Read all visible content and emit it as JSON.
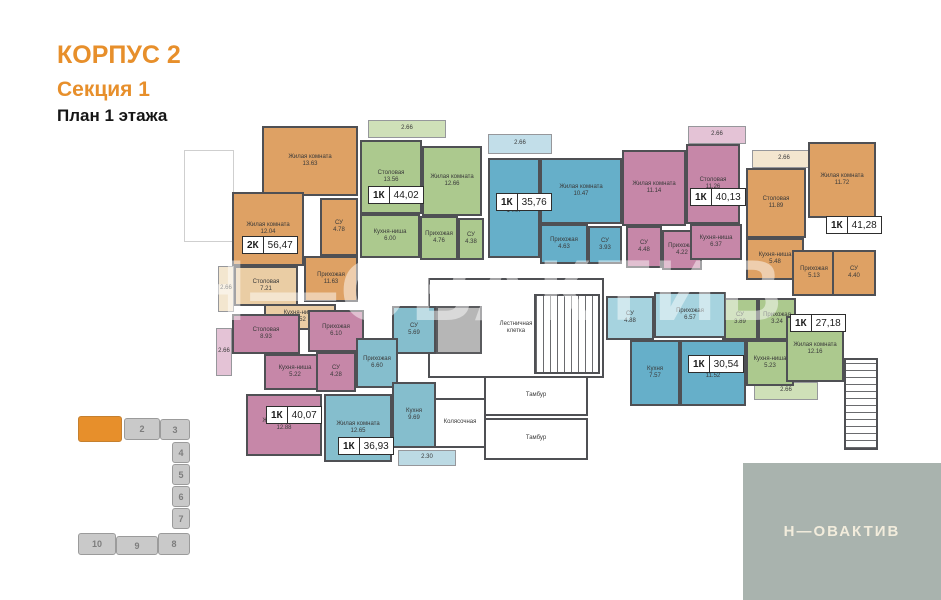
{
  "title": {
    "building": "КОРПУС 2",
    "section": "Секция 1",
    "floor": "План 1 этажа"
  },
  "watermark": "Н—ОВАКТИВ",
  "logo": {
    "text": "Н—ОВАКТИВ"
  },
  "palette": {
    "accent": "#E78F2B",
    "wall": "#4F5054",
    "orange": "#DEA164",
    "orange-light": "#EACDA4",
    "orange-pale": "#F3E6CF",
    "green": "#ACC98E",
    "green-pale": "#CFE0B8",
    "blue": "#66AFC9",
    "blue-light": "#A6D3DF",
    "blue-pale": "#C2DEE9",
    "pink": "#C687A8",
    "pink-pale": "#E4C3D6",
    "teal": "#85BECD",
    "teal-pale": "#BCDAE4",
    "logo-bg": "#A9B3AE",
    "minimap-gray": "#C9C9C9"
  },
  "plan": {
    "rooms": [
      {
        "id": "ghost-outline",
        "name": "",
        "area": "",
        "x": 184,
        "y": 150,
        "w": 50,
        "h": 92,
        "fill": "ghost"
      },
      {
        "id": "stairwell",
        "name": "Лестничная\nклетка",
        "area": "",
        "x": 428,
        "y": 278,
        "w": 176,
        "h": 100,
        "fill": "white"
      },
      {
        "id": "vestibule-1",
        "name": "Тамбур",
        "area": "",
        "x": 484,
        "y": 376,
        "w": 104,
        "h": 40,
        "fill": "white"
      },
      {
        "id": "stroller-room",
        "name": "Колясочная",
        "area": "",
        "x": 434,
        "y": 398,
        "w": 52,
        "h": 50,
        "fill": "white"
      },
      {
        "id": "vestibule-2",
        "name": "Тамбур",
        "area": "",
        "x": 484,
        "y": 418,
        "w": 104,
        "h": 42,
        "fill": "white"
      },
      {
        "id": "elevator",
        "name": "",
        "area": "",
        "x": 436,
        "y": 306,
        "w": 46,
        "h": 48,
        "fill": "elevator"
      },
      {
        "id": "stairs-main",
        "name": "",
        "area": "",
        "x": 534,
        "y": 294,
        "w": 66,
        "h": 80,
        "fill": "hatch-x"
      },
      {
        "id": "stairs-right",
        "name": "",
        "area": "",
        "x": 844,
        "y": 358,
        "w": 34,
        "h": 92,
        "fill": "hatch-y"
      },
      {
        "id": "apt1-living-1",
        "name": "Жилая комната",
        "area": "13.63",
        "x": 262,
        "y": 126,
        "w": 96,
        "h": 70,
        "fill": "orange"
      },
      {
        "id": "apt1-living-2",
        "name": "Жилая комната",
        "area": "12.04",
        "x": 232,
        "y": 192,
        "w": 72,
        "h": 74,
        "fill": "orange"
      },
      {
        "id": "apt1-bathroom",
        "name": "СУ",
        "area": "4.78",
        "x": 320,
        "y": 198,
        "w": 38,
        "h": 58,
        "fill": "orange"
      },
      {
        "id": "apt1-hallway",
        "name": "Прихожая",
        "area": "11.63",
        "x": 304,
        "y": 256,
        "w": 54,
        "h": 46,
        "fill": "orange"
      },
      {
        "id": "apt1-dining",
        "name": "Столовая",
        "area": "7.21",
        "x": 234,
        "y": 266,
        "w": 64,
        "h": 40,
        "fill": "orange-light"
      },
      {
        "id": "apt1-kitchen-niche",
        "name": "Кухня-ниша",
        "area": "4.52",
        "x": 264,
        "y": 304,
        "w": 72,
        "h": 26,
        "fill": "orange-light"
      },
      {
        "id": "apt1-balcony",
        "name": "",
        "area": "2.66",
        "x": 218,
        "y": 266,
        "w": 16,
        "h": 46,
        "fill": "orange-pale"
      },
      {
        "id": "apt2-balcony",
        "name": "",
        "area": "2.66",
        "x": 368,
        "y": 120,
        "w": 78,
        "h": 18,
        "fill": "green-pale"
      },
      {
        "id": "apt2-dining",
        "name": "Столовая",
        "area": "13.56",
        "x": 360,
        "y": 140,
        "w": 62,
        "h": 74,
        "fill": "green"
      },
      {
        "id": "apt2-living",
        "name": "Жилая комната",
        "area": "12.66",
        "x": 422,
        "y": 146,
        "w": 60,
        "h": 70,
        "fill": "green"
      },
      {
        "id": "apt2-kitchen-niche",
        "name": "Кухня-ниша",
        "area": "6.00",
        "x": 360,
        "y": 214,
        "w": 60,
        "h": 44,
        "fill": "green"
      },
      {
        "id": "apt2-hallway",
        "name": "Прихожая",
        "area": "4.76",
        "x": 420,
        "y": 216,
        "w": 38,
        "h": 44,
        "fill": "green"
      },
      {
        "id": "apt2-bathroom",
        "name": "СУ",
        "area": "4.38",
        "x": 458,
        "y": 218,
        "w": 26,
        "h": 42,
        "fill": "green"
      },
      {
        "id": "apt3-balcony",
        "name": "",
        "area": "2.66",
        "x": 488,
        "y": 134,
        "w": 64,
        "h": 20,
        "fill": "blue-pale"
      },
      {
        "id": "apt3-kitchen",
        "name": "Кухня",
        "area": "14.07",
        "x": 488,
        "y": 158,
        "w": 52,
        "h": 100,
        "fill": "blue"
      },
      {
        "id": "apt3-living",
        "name": "Жилая комната",
        "area": "10.47",
        "x": 540,
        "y": 158,
        "w": 82,
        "h": 66,
        "fill": "blue"
      },
      {
        "id": "apt3-hallway",
        "name": "Прихожая",
        "area": "4.63",
        "x": 540,
        "y": 224,
        "w": 48,
        "h": 40,
        "fill": "blue"
      },
      {
        "id": "apt3-bathroom",
        "name": "СУ",
        "area": "3.93",
        "x": 588,
        "y": 226,
        "w": 34,
        "h": 38,
        "fill": "blue"
      },
      {
        "id": "apt4-living",
        "name": "Жилая комната",
        "area": "11.14",
        "x": 622,
        "y": 150,
        "w": 64,
        "h": 76,
        "fill": "pink"
      },
      {
        "id": "apt4-dining",
        "name": "Столовая",
        "area": "11.26",
        "x": 686,
        "y": 144,
        "w": 54,
        "h": 80,
        "fill": "pink"
      },
      {
        "id": "apt4-balcony",
        "name": "",
        "area": "2.66",
        "x": 688,
        "y": 126,
        "w": 58,
        "h": 18,
        "fill": "pink-pale"
      },
      {
        "id": "apt4-bathroom",
        "name": "СУ",
        "area": "4.48",
        "x": 626,
        "y": 226,
        "w": 36,
        "h": 42,
        "fill": "pink"
      },
      {
        "id": "apt4-hallway",
        "name": "Прихожая",
        "area": "4.22",
        "x": 662,
        "y": 230,
        "w": 40,
        "h": 40,
        "fill": "pink"
      },
      {
        "id": "apt4-kitchen-niche",
        "name": "Кухня-ниша",
        "area": "6.37",
        "x": 690,
        "y": 224,
        "w": 52,
        "h": 36,
        "fill": "pink"
      },
      {
        "id": "apt5-balcony",
        "name": "",
        "area": "2.66",
        "x": 752,
        "y": 150,
        "w": 64,
        "h": 18,
        "fill": "orange-pale"
      },
      {
        "id": "apt5-dining",
        "name": "Столовая",
        "area": "11.89",
        "x": 746,
        "y": 168,
        "w": 60,
        "h": 70,
        "fill": "orange"
      },
      {
        "id": "apt5-living",
        "name": "Жилая комната",
        "area": "11.72",
        "x": 808,
        "y": 142,
        "w": 68,
        "h": 76,
        "fill": "orange"
      },
      {
        "id": "apt5-kitchen-niche",
        "name": "Кухня-ниша",
        "area": "5.48",
        "x": 746,
        "y": 238,
        "w": 58,
        "h": 42,
        "fill": "orange"
      },
      {
        "id": "apt5-hallway",
        "name": "Прихожая",
        "area": "5.13",
        "x": 792,
        "y": 250,
        "w": 44,
        "h": 46,
        "fill": "orange"
      },
      {
        "id": "apt5-bathroom",
        "name": "СУ",
        "area": "4.40",
        "x": 832,
        "y": 250,
        "w": 44,
        "h": 46,
        "fill": "orange"
      },
      {
        "id": "apt6-bathroom",
        "name": "СУ",
        "area": "3.89",
        "x": 722,
        "y": 298,
        "w": 36,
        "h": 42,
        "fill": "green"
      },
      {
        "id": "apt6-hallway",
        "name": "Прихожая",
        "area": "3.24",
        "x": 758,
        "y": 298,
        "w": 38,
        "h": 42,
        "fill": "green"
      },
      {
        "id": "apt6-kitchen-niche",
        "name": "Кухня-ниша",
        "area": "5.23",
        "x": 746,
        "y": 340,
        "w": 48,
        "h": 46,
        "fill": "green"
      },
      {
        "id": "apt6-living",
        "name": "Жилая комната",
        "area": "12.16",
        "x": 786,
        "y": 316,
        "w": 58,
        "h": 66,
        "fill": "green"
      },
      {
        "id": "apt6-balcony",
        "name": "",
        "area": "2.66",
        "x": 754,
        "y": 382,
        "w": 64,
        "h": 18,
        "fill": "green-pale"
      },
      {
        "id": "apt7-bathroom",
        "name": "СУ",
        "area": "4.88",
        "x": 606,
        "y": 296,
        "w": 48,
        "h": 44,
        "fill": "blue-light"
      },
      {
        "id": "apt7-hallway",
        "name": "Прихожая",
        "area": "6.57",
        "x": 654,
        "y": 292,
        "w": 72,
        "h": 46,
        "fill": "blue-light"
      },
      {
        "id": "apt7-kitchen",
        "name": "Кухня",
        "area": "7.57",
        "x": 630,
        "y": 340,
        "w": 50,
        "h": 66,
        "fill": "blue"
      },
      {
        "id": "apt7-living",
        "name": "Жилая комната",
        "area": "11.52",
        "x": 680,
        "y": 340,
        "w": 66,
        "h": 66,
        "fill": "blue"
      },
      {
        "id": "apt8-dining",
        "name": "Столовая",
        "area": "8.93",
        "x": 232,
        "y": 314,
        "w": 68,
        "h": 40,
        "fill": "pink"
      },
      {
        "id": "apt8-hallway",
        "name": "Прихожая",
        "area": "6.10",
        "x": 308,
        "y": 310,
        "w": 56,
        "h": 42,
        "fill": "pink"
      },
      {
        "id": "apt8-kitchen-niche",
        "name": "Кухня-ниша",
        "area": "5.22",
        "x": 264,
        "y": 354,
        "w": 62,
        "h": 36,
        "fill": "pink"
      },
      {
        "id": "apt8-bathroom",
        "name": "СУ",
        "area": "4.28",
        "x": 316,
        "y": 352,
        "w": 40,
        "h": 40,
        "fill": "pink"
      },
      {
        "id": "apt8-living",
        "name": "Жилая комната",
        "area": "12.88",
        "x": 246,
        "y": 394,
        "w": 76,
        "h": 62,
        "fill": "pink"
      },
      {
        "id": "apt8-balcony",
        "name": "",
        "area": "2.66",
        "x": 216,
        "y": 328,
        "w": 16,
        "h": 48,
        "fill": "pink-pale"
      },
      {
        "id": "apt9-bathroom",
        "name": "СУ",
        "area": "5.69",
        "x": 392,
        "y": 306,
        "w": 44,
        "h": 48,
        "fill": "teal"
      },
      {
        "id": "apt9-hallway",
        "name": "Прихожая",
        "area": "6.60",
        "x": 356,
        "y": 338,
        "w": 42,
        "h": 50,
        "fill": "teal"
      },
      {
        "id": "apt9-kitchen",
        "name": "Кухня",
        "area": "9.69",
        "x": 392,
        "y": 382,
        "w": 44,
        "h": 66,
        "fill": "teal"
      },
      {
        "id": "apt9-living",
        "name": "Жилая комната",
        "area": "12.65",
        "x": 324,
        "y": 394,
        "w": 68,
        "h": 68,
        "fill": "teal"
      },
      {
        "id": "apt9-balcony",
        "name": "",
        "area": "2.30",
        "x": 398,
        "y": 450,
        "w": 58,
        "h": 16,
        "fill": "teal-pale"
      }
    ],
    "units": [
      {
        "id": "unit-2k-5647",
        "type": "2К",
        "area": "56,47",
        "x": 242,
        "y": 236
      },
      {
        "id": "unit-1k-4402",
        "type": "1К",
        "area": "44,02",
        "x": 368,
        "y": 186
      },
      {
        "id": "unit-1k-3576",
        "type": "1К",
        "area": "35,76",
        "x": 496,
        "y": 193
      },
      {
        "id": "unit-1k-4013",
        "type": "1К",
        "area": "40,13",
        "x": 690,
        "y": 188
      },
      {
        "id": "unit-1k-4128",
        "type": "1К",
        "area": "41,28",
        "x": 826,
        "y": 216
      },
      {
        "id": "unit-1k-2718",
        "type": "1К",
        "area": "27,18",
        "x": 790,
        "y": 314
      },
      {
        "id": "unit-1k-3054",
        "type": "1К",
        "area": "30,54",
        "x": 688,
        "y": 355
      },
      {
        "id": "unit-1k-4007",
        "type": "1К",
        "area": "40,07",
        "x": 266,
        "y": 406
      },
      {
        "id": "unit-1k-3693",
        "type": "1К",
        "area": "36,93",
        "x": 338,
        "y": 437
      }
    ]
  },
  "minimap": {
    "sections": [
      {
        "num": "",
        "active": true,
        "x": 78,
        "y": 416,
        "w": 44,
        "h": 26
      },
      {
        "num": "2",
        "active": false,
        "x": 124,
        "y": 418,
        "w": 36,
        "h": 22
      },
      {
        "num": "3",
        "active": false,
        "x": 160,
        "y": 419,
        "w": 30,
        "h": 21
      },
      {
        "num": "4",
        "active": false,
        "x": 172,
        "y": 442,
        "w": 18,
        "h": 21
      },
      {
        "num": "5",
        "active": false,
        "x": 172,
        "y": 464,
        "w": 18,
        "h": 21
      },
      {
        "num": "6",
        "active": false,
        "x": 172,
        "y": 486,
        "w": 18,
        "h": 21
      },
      {
        "num": "7",
        "active": false,
        "x": 172,
        "y": 508,
        "w": 18,
        "h": 21
      },
      {
        "num": "8",
        "active": false,
        "x": 158,
        "y": 533,
        "w": 32,
        "h": 22
      },
      {
        "num": "9",
        "active": false,
        "x": 116,
        "y": 536,
        "w": 42,
        "h": 19
      },
      {
        "num": "10",
        "active": false,
        "x": 78,
        "y": 533,
        "w": 38,
        "h": 22
      }
    ]
  }
}
